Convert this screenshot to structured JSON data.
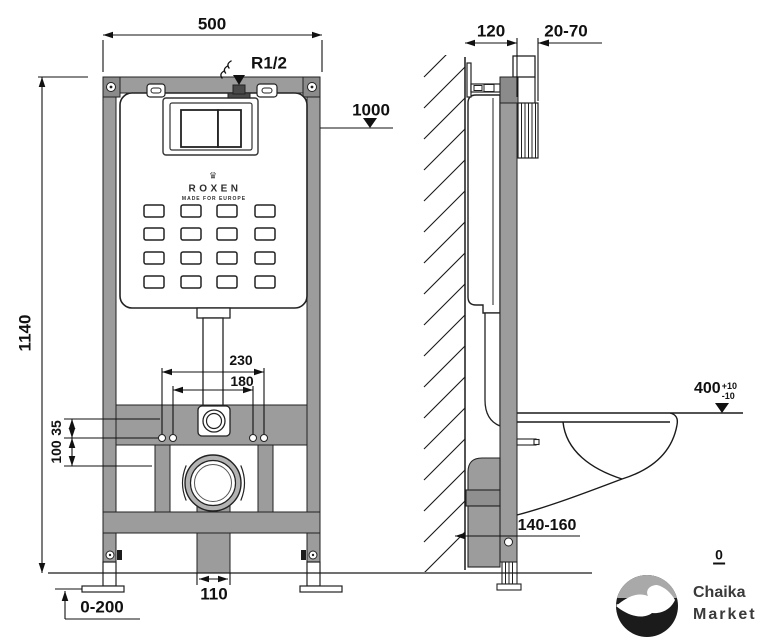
{
  "front_view": {
    "frame_width": "500",
    "frame_height": "1140",
    "flush_plate_height": "1000",
    "water_inlet": "R1/2",
    "mounting_holes_outer": "230",
    "mounting_holes_inner": "180",
    "offset_inlet": "35",
    "offset_holes": "100",
    "drain_pipe_width": "110",
    "feet_adjustment": "0-200",
    "brand": {
      "crown_icon": "♛",
      "name": "ROXEN",
      "tagline": "MADE FOR EUROPE"
    }
  },
  "side_view": {
    "frame_depth": "120",
    "plate_depth_range": "20-70",
    "bowl_height": "400",
    "bowl_height_tolerance_plus": "+10",
    "bowl_height_tolerance_minus": "-10",
    "outlet_height_range": "140-160",
    "floor_level": "0"
  },
  "watermark": {
    "line1": "Chaika",
    "line2": "Market"
  },
  "colors": {
    "frame_gray": "#9c9c9c",
    "dark_gray": "#8b8b8b",
    "line": "#1a1a1a"
  }
}
